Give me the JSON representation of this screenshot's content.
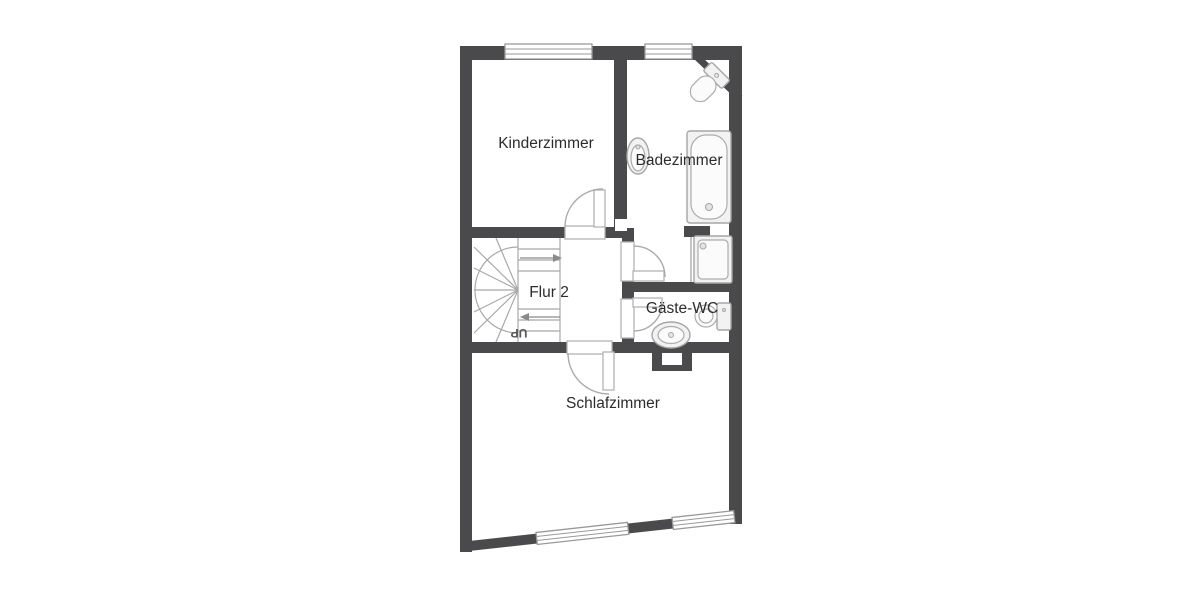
{
  "floorplan": {
    "type": "floor-plan",
    "floor_label": "Flur 2",
    "rooms": [
      {
        "id": "kinderzimmer",
        "label": "Kinderzimmer"
      },
      {
        "id": "badezimmer",
        "label": "Badezimmer"
      },
      {
        "id": "flur",
        "label": "Flur 2"
      },
      {
        "id": "gaeste_wc",
        "label": "Gäste-WC"
      },
      {
        "id": "schlafzimmer",
        "label": "Schlafzimmer"
      }
    ],
    "stairs": {
      "direction_label": "UP",
      "shape": "u-shaped-winder"
    },
    "fixtures": [
      "corner-toilet",
      "washbasin",
      "bathtub",
      "shower",
      "toilet",
      "oval-washbasin"
    ],
    "windows_count": 4,
    "doors_count": 4,
    "colors": {
      "wall": "#4a4a4c",
      "background": "#ffffff",
      "fixture_stroke": "#a6a6a6",
      "fixture_fill": "#f2f2f2",
      "stair_stroke": "#a8a8a8",
      "text": "#2c2c2c"
    }
  }
}
